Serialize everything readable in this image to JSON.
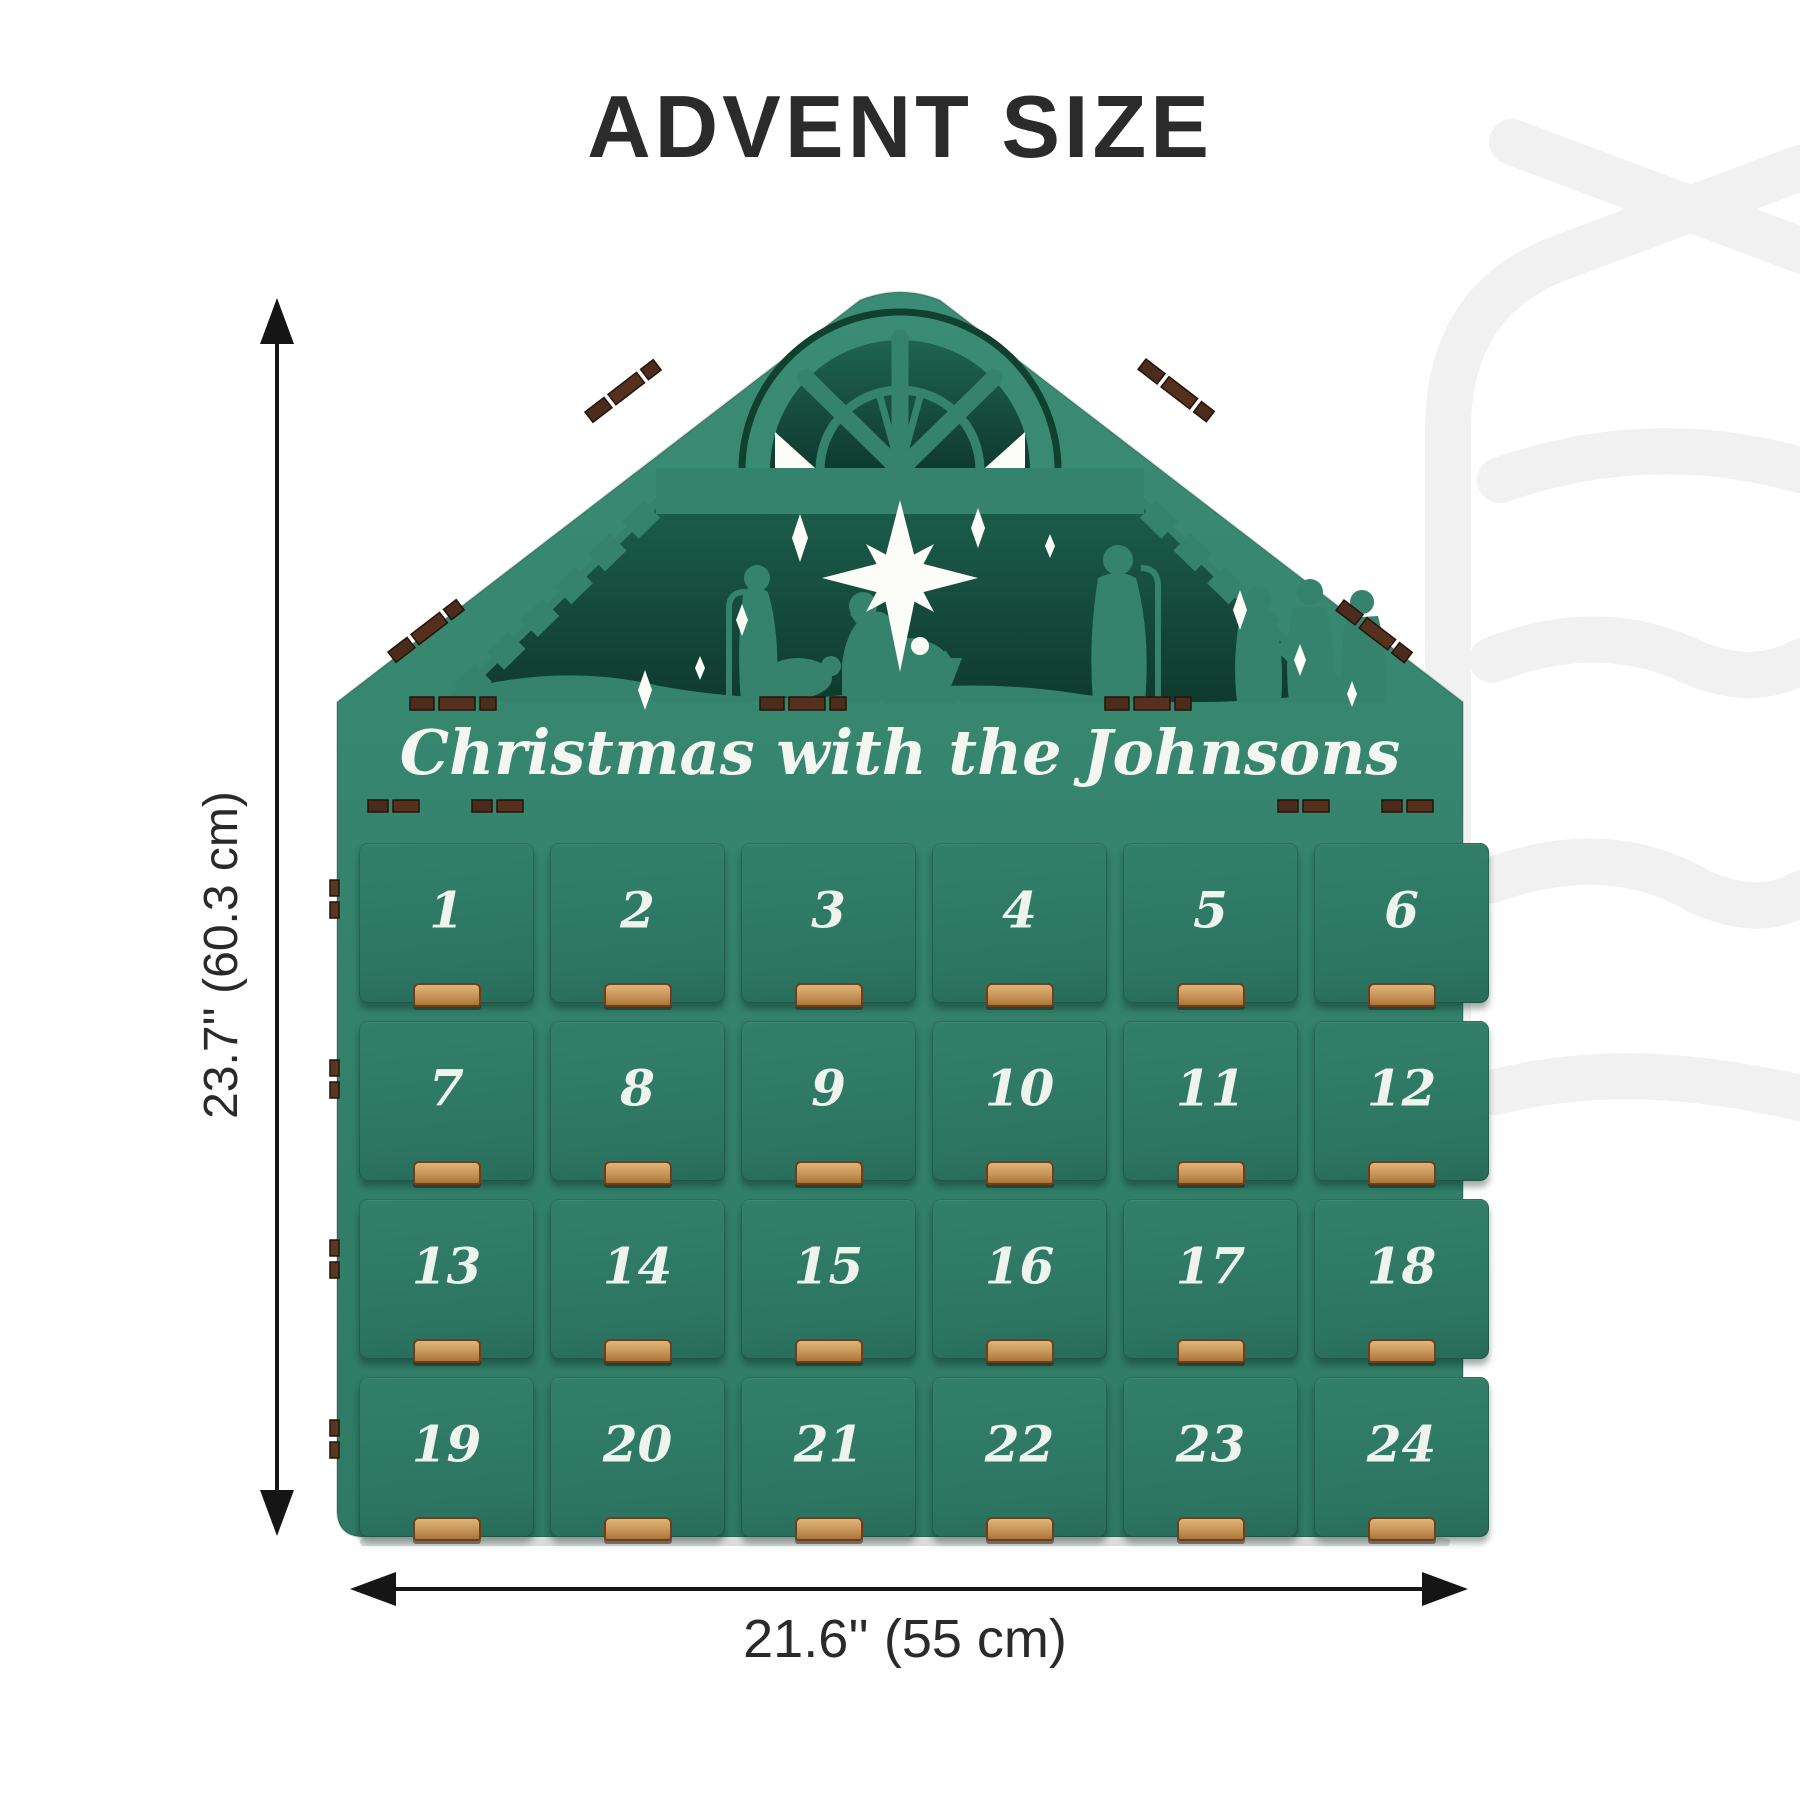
{
  "page": {
    "title": "ADVENT SIZE"
  },
  "calendar": {
    "banner_text": "Christmas with the Johnsons",
    "scene": "nativity-silhouette",
    "drawers": [
      "1",
      "2",
      "3",
      "4",
      "5",
      "6",
      "7",
      "8",
      "9",
      "10",
      "11",
      "12",
      "13",
      "14",
      "15",
      "16",
      "17",
      "18",
      "19",
      "20",
      "21",
      "22",
      "23",
      "24"
    ],
    "colors": {
      "board_green": "#35836D",
      "drawer_green": "#2F7C66",
      "interior_dark": "#123F33",
      "tab_wood": "#C89559",
      "slot_brown": "#4A2B1C",
      "number_white": "#EEF3EE"
    }
  },
  "dimensions": {
    "height_label": "23.7'' (60.3 cm)",
    "width_label": "21.6'' (55 cm)",
    "line_color": "#1A1A1A"
  },
  "watermark": {
    "color": "#F1F1F1"
  }
}
